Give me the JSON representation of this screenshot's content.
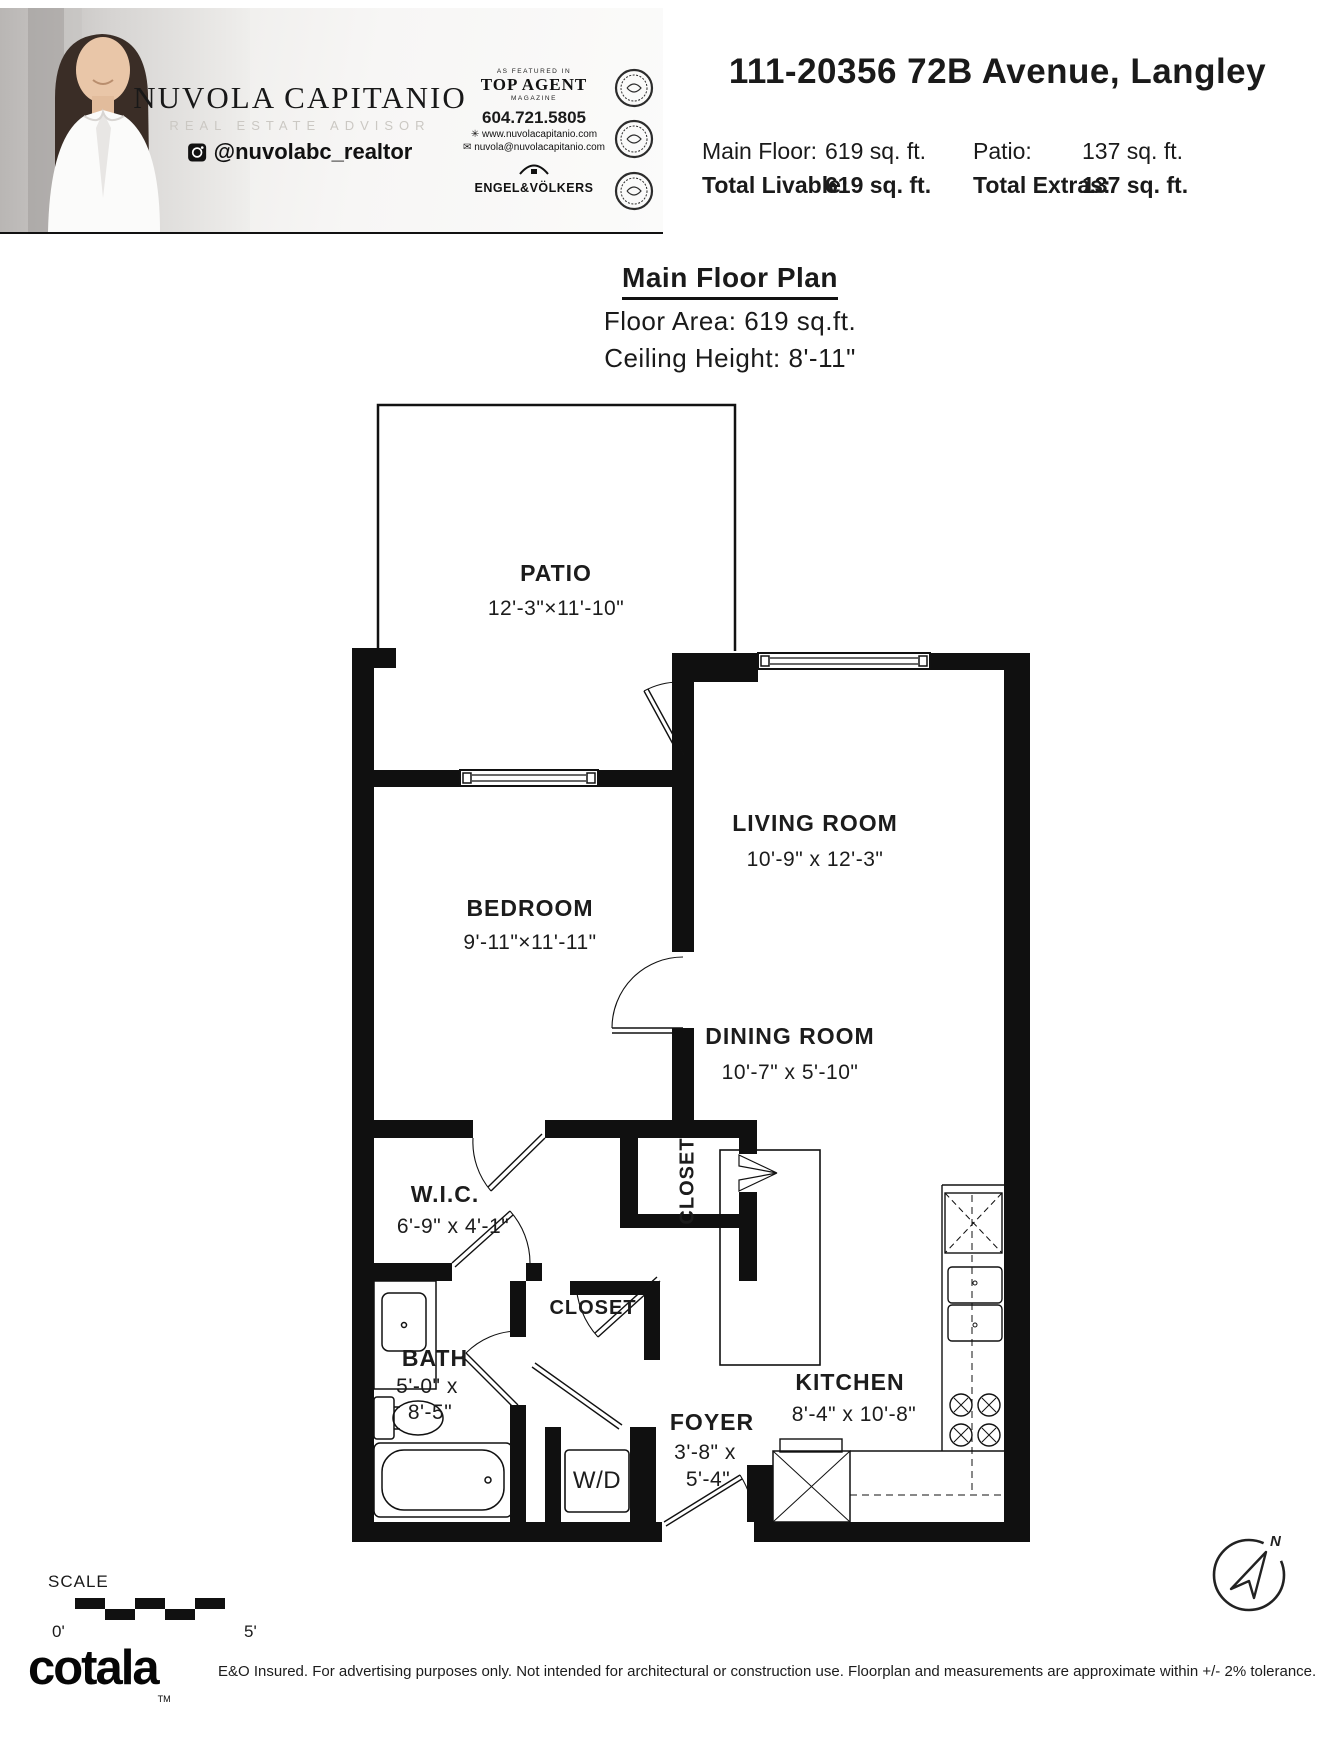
{
  "header": {
    "agent": {
      "name": "NUVOLA CAPITANIO",
      "role": "REAL ESTATE ADVISOR",
      "instagram": "@nuvolabc_realtor"
    },
    "badge": {
      "top": "AS FEATURED IN",
      "name": "TOP AGENT",
      "bottom": "MAGAZINE"
    },
    "contact": {
      "phone": "604.721.5805",
      "website": "www.nuvolacapitanio.com",
      "email": "nuvola@nuvolacapitanio.com",
      "brand": "ENGEL&VÖLKERS"
    },
    "address": "111-20356 72B Avenue, Langley",
    "stats": {
      "rows": [
        {
          "label": "Main Floor:",
          "value": "619 sq. ft."
        },
        {
          "label": "Total Livable:",
          "value": "619 sq. ft."
        },
        {
          "label": "Patio:",
          "value": "137 sq. ft."
        },
        {
          "label": "Total Extras:",
          "value": "137 sq. ft."
        }
      ]
    }
  },
  "title_block": {
    "title": "Main Floor Plan",
    "floor_area": "Floor Area: 619 sq.ft.",
    "ceiling_height": "Ceiling Height: 8'-11\""
  },
  "floorplan": {
    "rooms": [
      {
        "name": "PATIO",
        "dims": "12'-3\"×11'-10\""
      },
      {
        "name": "LIVING ROOM",
        "dims": "10'-9\" x 12'-3\""
      },
      {
        "name": "BEDROOM",
        "dims": "9'-11\"×11'-11\""
      },
      {
        "name": "DINING ROOM",
        "dims": "10'-7\" x 5'-10\""
      },
      {
        "name": "W.I.C.",
        "dims": "6'-9\"  x  4'-1\""
      },
      {
        "name": "CLOSET"
      },
      {
        "name": "CLOSET"
      },
      {
        "name": "BATH",
        "dims_line1": "5'-0\" x",
        "dims_line2": "8'-5\""
      },
      {
        "name": "FOYER",
        "dims_line1": "3'-8\" x",
        "dims_line2": "5'-4\""
      },
      {
        "name": "KITCHEN",
        "dims": "8'-4\" x 10'-8\""
      },
      {
        "name": "W/D"
      }
    ]
  },
  "scale_bar": {
    "label": "SCALE",
    "start": "0'",
    "end": "5'"
  },
  "compass": {
    "label": "N"
  },
  "footer": {
    "brand": "cotala",
    "tm": "TM",
    "disclaimer": "E&O Insured. For advertising purposes only. Not intended for architectural or construction use. Floorplan and measurements are approximate within +/- 2% tolerance."
  }
}
